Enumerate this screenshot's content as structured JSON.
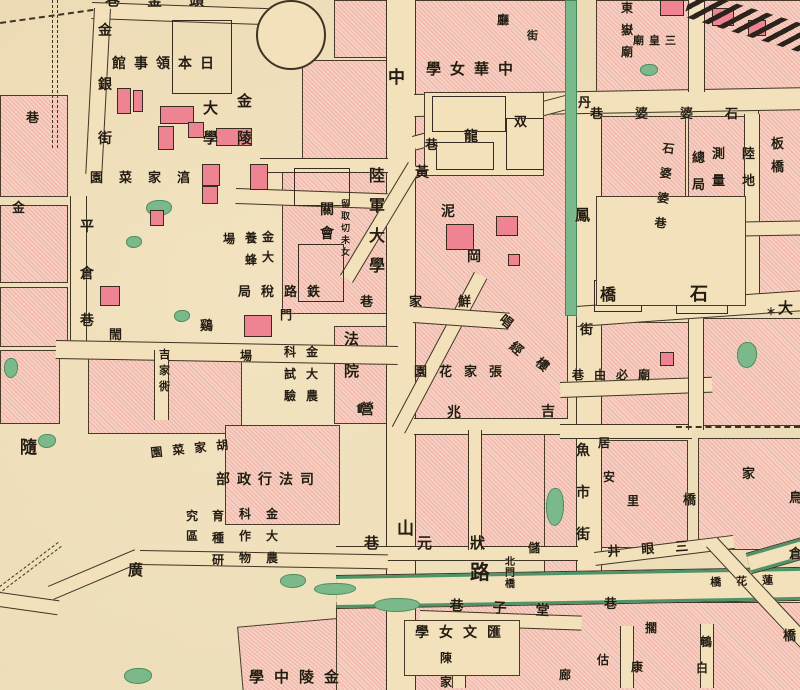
{
  "map_title": "historical-city-map",
  "colors": {
    "paper": "#f2e1ba",
    "block_pink": "#f6d0c3",
    "block_hatch": "#efb2a6",
    "building_rose": "#ee8392",
    "pond_green": "#7cb98a",
    "canal_green": "#79b98c",
    "line_ink": "#3f3324",
    "text_ink": "#241c12",
    "road_green_edge": "#4f9468"
  },
  "labels": [
    {
      "t": "頭釜巷",
      "d": "h",
      "x": 105,
      "y": -7,
      "s": 15,
      "g": 27
    },
    {
      "t": "巷",
      "x": 26,
      "y": 112,
      "s": 13
    },
    {
      "t": "金",
      "x": 12,
      "y": 202,
      "s": 13
    },
    {
      "t": "金銀街",
      "d": "v",
      "x": 98,
      "y": 24,
      "s": 14,
      "g": 40
    },
    {
      "t": "日本領事館",
      "d": "h",
      "x": 112,
      "y": 57,
      "s": 14,
      "g": 8
    },
    {
      "t": "金陵",
      "d": "v",
      "x": 237,
      "y": 94,
      "s": 15,
      "g": 22
    },
    {
      "t": "大學",
      "d": "v",
      "x": 203,
      "y": 101,
      "s": 15,
      "g": 15
    },
    {
      "t": "湻家菜園",
      "d": "h",
      "x": 90,
      "y": 172,
      "s": 13,
      "g": 16
    },
    {
      "t": "平倉巷",
      "d": "v",
      "x": 80,
      "y": 220,
      "s": 14,
      "g": 33
    },
    {
      "t": "金大",
      "d": "v",
      "x": 262,
      "y": 231,
      "s": 12,
      "g": 8
    },
    {
      "t": "養蜂",
      "d": "v",
      "x": 245,
      "y": 232,
      "s": 12,
      "g": 10
    },
    {
      "t": "場",
      "x": 223,
      "y": 233,
      "s": 12
    },
    {
      "t": "鉄路稅局",
      "d": "h",
      "x": 238,
      "y": 286,
      "s": 13,
      "g": 10
    },
    {
      "t": "門",
      "x": 280,
      "y": 309,
      "s": 12
    },
    {
      "t": "閙",
      "x": 109,
      "y": 329,
      "s": 13
    },
    {
      "t": "鷄",
      "x": 200,
      "y": 320,
      "s": 13
    },
    {
      "t": "吉家衖",
      "d": "v",
      "x": 159,
      "y": 349,
      "s": 11,
      "g": 5
    },
    {
      "t": "隨",
      "x": 20,
      "y": 440,
      "s": 17
    },
    {
      "t": "胡家菜園",
      "d": "h",
      "x": 150,
      "y": 447,
      "s": 12,
      "g": 10,
      "r": -6
    },
    {
      "t": "司法行政部",
      "d": "h",
      "x": 216,
      "y": 473,
      "s": 14,
      "g": 7
    },
    {
      "t": "金大農",
      "d": "v",
      "x": 306,
      "y": 346,
      "s": 12,
      "g": 10
    },
    {
      "t": "科試驗",
      "d": "v",
      "x": 284,
      "y": 346,
      "s": 12,
      "g": 10
    },
    {
      "t": "場",
      "x": 240,
      "y": 350,
      "s": 12
    },
    {
      "t": "金大農",
      "d": "v",
      "x": 266,
      "y": 508,
      "s": 12,
      "g": 10
    },
    {
      "t": "科作物",
      "d": "v",
      "x": 239,
      "y": 508,
      "s": 12,
      "g": 10
    },
    {
      "t": "育種研",
      "d": "v",
      "x": 212,
      "y": 510,
      "s": 12,
      "g": 10
    },
    {
      "t": "究區",
      "d": "v",
      "x": 186,
      "y": 510,
      "s": 12,
      "g": 8
    },
    {
      "t": "廣",
      "x": 128,
      "y": 563,
      "s": 15
    },
    {
      "t": "金陵中學",
      "d": "h",
      "x": 249,
      "y": 670,
      "s": 15,
      "g": 10
    },
    {
      "t": "陸軍大學",
      "d": "v",
      "x": 369,
      "y": 168,
      "s": 16,
      "g": 14
    },
    {
      "t": "關會",
      "d": "v",
      "x": 320,
      "y": 203,
      "s": 14,
      "g": 10
    },
    {
      "t": "留取切未女",
      "d": "v",
      "x": 341,
      "y": 201,
      "s": 9,
      "g": 3
    },
    {
      "t": "法院",
      "d": "v",
      "x": 344,
      "y": 332,
      "s": 15,
      "g": 17
    },
    {
      "t": "中",
      "x": 388,
      "y": 70,
      "s": 17
    },
    {
      "t": "山",
      "x": 397,
      "y": 521,
      "s": 17
    },
    {
      "t": "路",
      "x": 470,
      "y": 562,
      "s": 20
    },
    {
      "t": "中華女學",
      "d": "h",
      "x": 426,
      "y": 62,
      "s": 15,
      "g": 9
    },
    {
      "t": "双",
      "x": 514,
      "y": 116,
      "s": 13
    },
    {
      "t": "龍",
      "x": 464,
      "y": 130,
      "s": 14
    },
    {
      "t": "巷",
      "x": 425,
      "y": 139,
      "s": 13
    },
    {
      "t": "黃",
      "x": 415,
      "y": 166,
      "s": 14
    },
    {
      "t": "泥",
      "x": 441,
      "y": 205,
      "s": 14
    },
    {
      "t": "岡",
      "x": 467,
      "y": 250,
      "s": 14
    },
    {
      "t": "唱",
      "x": 505,
      "y": 313,
      "s": 13,
      "r": 40
    },
    {
      "t": "經",
      "x": 515,
      "y": 340,
      "s": 13,
      "r": 40
    },
    {
      "t": "樓",
      "x": 541,
      "y": 356,
      "s": 13,
      "r": 40
    },
    {
      "t": "鮮家巷",
      "d": "h",
      "x": 360,
      "y": 296,
      "s": 13,
      "g": 36
    },
    {
      "t": "張家花園",
      "d": "h",
      "x": 414,
      "y": 366,
      "s": 13,
      "g": 12
    },
    {
      "t": "營",
      "x": 360,
      "y": 403,
      "s": 14
    },
    {
      "t": "兆",
      "x": 447,
      "y": 406,
      "s": 14
    },
    {
      "t": "吉",
      "x": 541,
      "y": 405,
      "s": 14
    },
    {
      "t": "狀元巷",
      "d": "h",
      "x": 364,
      "y": 536,
      "s": 15,
      "g": 38
    },
    {
      "t": "北門橋",
      "d": "v",
      "x": 505,
      "y": 558,
      "s": 10,
      "g": 1
    },
    {
      "t": "儲",
      "x": 528,
      "y": 542,
      "s": 12
    },
    {
      "t": "廳",
      "x": 497,
      "y": 14,
      "s": 12
    },
    {
      "t": "街",
      "x": 527,
      "y": 30,
      "s": 11
    },
    {
      "t": "東嶽廟",
      "d": "v",
      "x": 621,
      "y": 2,
      "s": 12,
      "g": 10
    },
    {
      "t": "三皇廟",
      "d": "h",
      "x": 633,
      "y": 35,
      "s": 11,
      "g": 5
    },
    {
      "t": "石婆婆巷",
      "d": "h",
      "x": 590,
      "y": 108,
      "s": 13,
      "g": 32
    },
    {
      "t": "石婆婆巷",
      "d": "v",
      "x": 663,
      "y": 142,
      "s": 12,
      "g": 13,
      "r": 6
    },
    {
      "t": "陸地",
      "d": "v",
      "x": 742,
      "y": 148,
      "s": 13,
      "g": 14
    },
    {
      "t": "測量",
      "d": "v",
      "x": 712,
      "y": 148,
      "s": 13,
      "g": 14
    },
    {
      "t": "總局",
      "d": "v",
      "x": 692,
      "y": 152,
      "s": 13,
      "g": 14
    },
    {
      "t": "板橋",
      "d": "v",
      "x": 771,
      "y": 138,
      "s": 13,
      "g": 10
    },
    {
      "t": "丹",
      "x": 578,
      "y": 97,
      "s": 13
    },
    {
      "t": "鳳",
      "x": 575,
      "y": 208,
      "s": 15
    },
    {
      "t": "街",
      "x": 580,
      "y": 324,
      "s": 13
    },
    {
      "t": "橋",
      "x": 600,
      "y": 287,
      "s": 16
    },
    {
      "t": "石",
      "x": 690,
      "y": 286,
      "s": 18
    },
    {
      "t": "大",
      "x": 778,
      "y": 301,
      "s": 15
    },
    {
      "t": "廟必由巷",
      "d": "h",
      "x": 572,
      "y": 369,
      "s": 12,
      "g": 10
    },
    {
      "t": "魚市街",
      "d": "v",
      "x": 576,
      "y": 444,
      "s": 14,
      "g": 28
    },
    {
      "t": "居",
      "x": 598,
      "y": 437,
      "s": 12
    },
    {
      "t": "安",
      "x": 603,
      "y": 471,
      "s": 12
    },
    {
      "t": "里",
      "x": 627,
      "y": 495,
      "s": 12
    },
    {
      "t": "家",
      "x": 742,
      "y": 468,
      "s": 13
    },
    {
      "t": "橋",
      "x": 683,
      "y": 494,
      "s": 13
    },
    {
      "t": "鳥",
      "x": 789,
      "y": 492,
      "s": 13
    },
    {
      "t": "倉",
      "x": 789,
      "y": 548,
      "s": 13
    },
    {
      "t": "三眼井",
      "d": "h",
      "x": 607,
      "y": 546,
      "s": 13,
      "g": 21,
      "r": -4
    },
    {
      "t": "蓮花橋",
      "d": "h",
      "x": 710,
      "y": 577,
      "s": 11,
      "g": 15,
      "r": -2
    },
    {
      "t": "堂子巷",
      "d": "h",
      "x": 450,
      "y": 599,
      "s": 14,
      "g": 29,
      "r": 3
    },
    {
      "t": "巷",
      "x": 604,
      "y": 598,
      "s": 13
    },
    {
      "t": "匯文女學",
      "d": "h",
      "x": 415,
      "y": 626,
      "s": 14,
      "g": 10
    },
    {
      "t": "陳家",
      "d": "v",
      "x": 440,
      "y": 652,
      "s": 12,
      "g": 12
    },
    {
      "t": "估",
      "x": 597,
      "y": 654,
      "s": 12
    },
    {
      "t": "康",
      "x": 631,
      "y": 661,
      "s": 12
    },
    {
      "t": "廊",
      "x": 559,
      "y": 669,
      "s": 12
    },
    {
      "t": "擱",
      "x": 645,
      "y": 622,
      "s": 12
    },
    {
      "t": "鵪",
      "x": 700,
      "y": 636,
      "s": 12
    },
    {
      "t": "白",
      "x": 696,
      "y": 662,
      "s": 12
    },
    {
      "t": "橋",
      "x": 783,
      "y": 630,
      "s": 13
    }
  ],
  "blocks": [
    {
      "x": 0,
      "y": 95,
      "w": 66,
      "h": 100
    },
    {
      "x": 0,
      "y": 205,
      "w": 66,
      "h": 76
    },
    {
      "x": 0,
      "y": 287,
      "w": 66,
      "h": 58
    },
    {
      "x": 0,
      "y": 350,
      "w": 58,
      "h": 72
    },
    {
      "x": 88,
      "y": 350,
      "w": 152,
      "h": 82
    },
    {
      "x": 225,
      "y": 425,
      "w": 113,
      "h": 98
    },
    {
      "x": 240,
      "y": 620,
      "w": 150,
      "h": 72,
      "r": -5
    },
    {
      "x": 302,
      "y": 60,
      "w": 84,
      "h": 102
    },
    {
      "x": 282,
      "y": 162,
      "w": 104,
      "h": 150
    },
    {
      "x": 334,
      "y": 0,
      "w": 52,
      "h": 56
    },
    {
      "x": 334,
      "y": 326,
      "w": 52,
      "h": 96
    },
    {
      "x": 414,
      "y": 0,
      "w": 152,
      "h": 94
    },
    {
      "x": 414,
      "y": 108,
      "w": 152,
      "h": 440
    },
    {
      "x": 596,
      "y": 0,
      "w": 204,
      "h": 90
    },
    {
      "x": 596,
      "y": 116,
      "w": 88,
      "h": 82
    },
    {
      "x": 688,
      "y": 116,
      "w": 56,
      "h": 120
    },
    {
      "x": 758,
      "y": 108,
      "w": 42,
      "h": 196
    },
    {
      "x": 600,
      "y": 322,
      "w": 88,
      "h": 106
    },
    {
      "x": 702,
      "y": 318,
      "w": 98,
      "h": 106
    },
    {
      "x": 600,
      "y": 440,
      "w": 86,
      "h": 106
    },
    {
      "x": 698,
      "y": 438,
      "w": 102,
      "h": 110
    },
    {
      "x": 544,
      "y": 432,
      "w": 32,
      "h": 150
    },
    {
      "x": 336,
      "y": 602,
      "w": 464,
      "h": 88
    }
  ],
  "roads": [
    {
      "x": 386,
      "y": 0,
      "w": 28,
      "h": 690,
      "k": "v"
    },
    {
      "x": 576,
      "y": 92,
      "w": 24,
      "h": 496,
      "k": "v"
    },
    {
      "x": 92,
      "y": 2,
      "w": 176,
      "h": 15,
      "r": 2,
      "k": "h"
    },
    {
      "x": 94,
      "y": 8,
      "w": 15,
      "h": 166,
      "r": 3,
      "k": "v"
    },
    {
      "x": 70,
      "y": 196,
      "w": 15,
      "h": 158,
      "k": "v"
    },
    {
      "x": 414,
      "y": 94,
      "w": 386,
      "h": 21,
      "r": -1,
      "k": "h"
    },
    {
      "x": 56,
      "y": 340,
      "w": 342,
      "h": 17,
      "r": 1,
      "k": "h"
    },
    {
      "x": 154,
      "y": 350,
      "w": 13,
      "h": 70,
      "k": "v"
    },
    {
      "x": 236,
      "y": 188,
      "w": 152,
      "h": 14,
      "r": 2,
      "k": "h"
    },
    {
      "x": 260,
      "y": 158,
      "w": 128,
      "h": 13,
      "k": "h"
    },
    {
      "x": 412,
      "y": 136,
      "w": 162,
      "h": 13,
      "r": -15,
      "k": "h"
    },
    {
      "x": 408,
      "y": 162,
      "w": 13,
      "h": 132,
      "r": 31,
      "k": "v"
    },
    {
      "x": 474,
      "y": 272,
      "w": 13,
      "h": 175,
      "r": 28,
      "k": "v"
    },
    {
      "x": 414,
      "y": 306,
      "w": 96,
      "h": 15,
      "r": 4,
      "k": "h"
    },
    {
      "x": 414,
      "y": 418,
      "w": 154,
      "h": 15,
      "k": "h"
    },
    {
      "x": 560,
      "y": 382,
      "w": 152,
      "h": 14,
      "r": -2,
      "k": "h"
    },
    {
      "x": 560,
      "y": 424,
      "w": 132,
      "h": 13,
      "k": "h"
    },
    {
      "x": 336,
      "y": 546,
      "w": 242,
      "h": 13,
      "k": "h"
    },
    {
      "x": 336,
      "y": 576,
      "w": 470,
      "h": 26,
      "r": -1,
      "k": "g"
    },
    {
      "x": 746,
      "y": 554,
      "w": 78,
      "h": 14,
      "r": -16,
      "k": "g"
    },
    {
      "x": 420,
      "y": 610,
      "w": 162,
      "h": 13,
      "r": 2,
      "k": "h"
    },
    {
      "x": 594,
      "y": 552,
      "w": 140,
      "h": 12,
      "r": -7,
      "k": "h"
    },
    {
      "x": 706,
      "y": 547,
      "w": 13,
      "h": 200,
      "r": -43,
      "k": "v"
    },
    {
      "x": 140,
      "y": 550,
      "w": 248,
      "h": 13,
      "r": 1,
      "k": "h"
    },
    {
      "x": 48,
      "y": 586,
      "w": 94,
      "h": 13,
      "r": -23,
      "k": "h"
    },
    {
      "x": 0,
      "y": 592,
      "w": 60,
      "h": 13,
      "r": 8,
      "k": "h"
    },
    {
      "x": 452,
      "y": 624,
      "w": 12,
      "h": 64,
      "k": "v"
    },
    {
      "x": 620,
      "y": 626,
      "w": 12,
      "h": 62,
      "k": "v"
    },
    {
      "x": 700,
      "y": 624,
      "w": 12,
      "h": 64,
      "k": "v"
    },
    {
      "x": 688,
      "y": 0,
      "w": 15,
      "h": 92,
      "k": "v"
    },
    {
      "x": 744,
      "y": 114,
      "w": 14,
      "h": 190,
      "k": "v"
    },
    {
      "x": 688,
      "y": 318,
      "w": 14,
      "h": 112,
      "k": "v"
    },
    {
      "x": 596,
      "y": 224,
      "w": 210,
      "h": 13,
      "r": -1,
      "k": "h"
    },
    {
      "x": 576,
      "y": 306,
      "w": 226,
      "h": 19,
      "r": -4,
      "k": "h"
    },
    {
      "x": 468,
      "y": 430,
      "w": 12,
      "h": 120,
      "k": "v"
    }
  ],
  "canals": [
    {
      "x": 565,
      "y": 0,
      "w": 10,
      "h": 314
    }
  ],
  "dashes": [
    {
      "x": 52,
      "y": 0,
      "w": 4,
      "h": 148,
      "k": "vv"
    },
    {
      "x": 58,
      "y": 542,
      "w": 4,
      "h": 240,
      "r": 53,
      "k": "vv"
    },
    {
      "x": 676,
      "y": 426,
      "w": 124,
      "h": 0,
      "k": "hh"
    },
    {
      "x": 0,
      "y": 22,
      "w": 94,
      "h": 0,
      "r": -8,
      "k": "hh"
    }
  ],
  "ponds": [
    {
      "x": 146,
      "y": 200,
      "w": 24,
      "h": 14
    },
    {
      "x": 126,
      "y": 236,
      "w": 14,
      "h": 10
    },
    {
      "x": 174,
      "y": 310,
      "w": 14,
      "h": 10
    },
    {
      "x": 4,
      "y": 358,
      "w": 12,
      "h": 18
    },
    {
      "x": 38,
      "y": 434,
      "w": 16,
      "h": 12
    },
    {
      "x": 608,
      "y": 208,
      "w": 26,
      "h": 12
    },
    {
      "x": 640,
      "y": 64,
      "w": 16,
      "h": 10
    },
    {
      "x": 634,
      "y": 254,
      "w": 24,
      "h": 12
    },
    {
      "x": 676,
      "y": 258,
      "w": 30,
      "h": 12
    },
    {
      "x": 737,
      "y": 342,
      "w": 18,
      "h": 24
    },
    {
      "x": 280,
      "y": 574,
      "w": 24,
      "h": 12
    },
    {
      "x": 314,
      "y": 583,
      "w": 40,
      "h": 10
    },
    {
      "x": 124,
      "y": 668,
      "w": 26,
      "h": 14
    },
    {
      "x": 374,
      "y": 598,
      "w": 44,
      "h": 12
    },
    {
      "x": 546,
      "y": 488,
      "w": 16,
      "h": 36
    }
  ],
  "buildings": [
    {
      "x": 117,
      "y": 88,
      "w": 12,
      "h": 24,
      "k": "s"
    },
    {
      "x": 133,
      "y": 90,
      "w": 8,
      "h": 20,
      "k": "s"
    },
    {
      "x": 160,
      "y": 106,
      "w": 32,
      "h": 16,
      "k": "s"
    },
    {
      "x": 158,
      "y": 126,
      "w": 14,
      "h": 22,
      "k": "s"
    },
    {
      "x": 188,
      "y": 122,
      "w": 14,
      "h": 14,
      "k": "s"
    },
    {
      "x": 216,
      "y": 128,
      "w": 34,
      "h": 16,
      "k": "s"
    },
    {
      "x": 202,
      "y": 164,
      "w": 16,
      "h": 20,
      "k": "s"
    },
    {
      "x": 250,
      "y": 164,
      "w": 16,
      "h": 24,
      "k": "s"
    },
    {
      "x": 202,
      "y": 186,
      "w": 14,
      "h": 16,
      "k": "s"
    },
    {
      "x": 282,
      "y": 16,
      "w": 22,
      "h": 26,
      "k": "s"
    },
    {
      "x": 172,
      "y": 20,
      "w": 58,
      "h": 72,
      "k": "o"
    },
    {
      "x": 150,
      "y": 210,
      "w": 12,
      "h": 14,
      "k": "s"
    },
    {
      "x": 100,
      "y": 286,
      "w": 18,
      "h": 18,
      "k": "s"
    },
    {
      "x": 244,
      "y": 315,
      "w": 26,
      "h": 20,
      "k": "s"
    },
    {
      "x": 446,
      "y": 224,
      "w": 26,
      "h": 24,
      "k": "s"
    },
    {
      "x": 496,
      "y": 216,
      "w": 20,
      "h": 18,
      "k": "s"
    },
    {
      "x": 508,
      "y": 254,
      "w": 10,
      "h": 10,
      "k": "s"
    },
    {
      "x": 660,
      "y": 352,
      "w": 12,
      "h": 12,
      "k": "s"
    },
    {
      "x": 712,
      "y": 8,
      "w": 20,
      "h": 16,
      "k": "s"
    },
    {
      "x": 748,
      "y": 20,
      "w": 16,
      "h": 14,
      "k": "s"
    },
    {
      "x": 660,
      "y": 0,
      "w": 22,
      "h": 14,
      "k": "s"
    },
    {
      "x": 676,
      "y": 270,
      "w": 50,
      "h": 42,
      "k": "o"
    },
    {
      "x": 594,
      "y": 280,
      "w": 46,
      "h": 30,
      "k": "o"
    },
    {
      "x": 424,
      "y": 92,
      "w": 118,
      "h": 82,
      "k": "c"
    },
    {
      "x": 432,
      "y": 96,
      "w": 72,
      "h": 34,
      "k": "o"
    },
    {
      "x": 436,
      "y": 142,
      "w": 56,
      "h": 26,
      "k": "o"
    },
    {
      "x": 506,
      "y": 118,
      "w": 36,
      "h": 50,
      "k": "o"
    },
    {
      "x": 294,
      "y": 168,
      "w": 54,
      "h": 36,
      "k": "o"
    },
    {
      "x": 298,
      "y": 244,
      "w": 44,
      "h": 56,
      "k": "o"
    },
    {
      "x": 596,
      "y": 196,
      "w": 148,
      "h": 108,
      "k": "c"
    },
    {
      "x": 404,
      "y": 620,
      "w": 114,
      "h": 54,
      "k": "c"
    }
  ],
  "extras": {
    "ring": {
      "x": 256,
      "y": 0,
      "d": 66
    },
    "rail": {
      "x": 692,
      "y": -10,
      "w": 140,
      "h": 28,
      "r": 17
    },
    "star": {
      "x": 766,
      "y": 303,
      "ch": "＊"
    },
    "shrine": {
      "x": 356,
      "y": 403
    }
  }
}
